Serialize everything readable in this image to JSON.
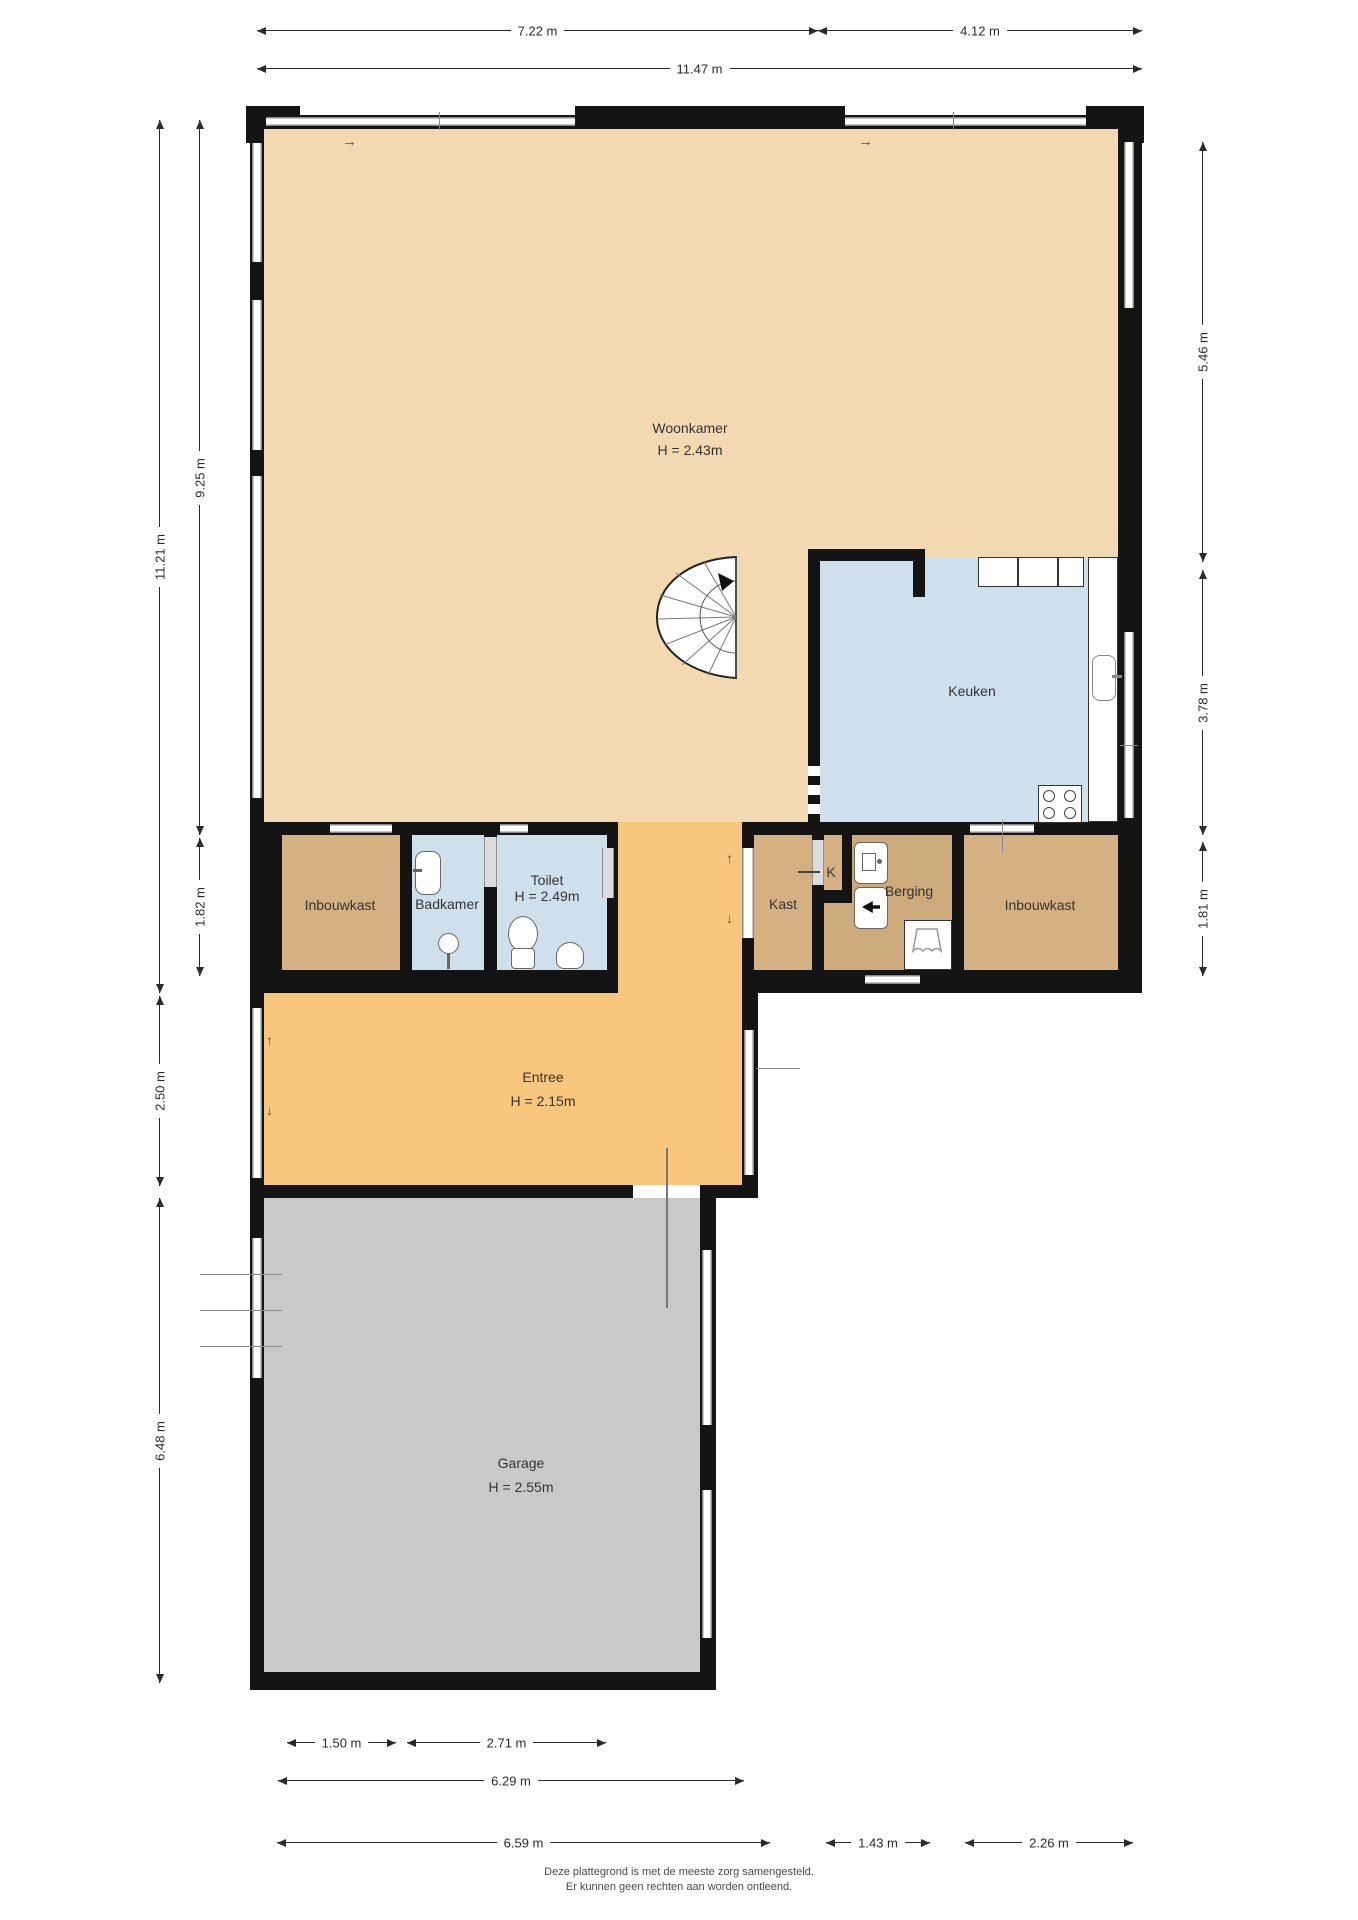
{
  "rooms": {
    "woonkamer": {
      "name": "Woonkamer",
      "h": "H = 2.43m"
    },
    "keuken": {
      "name": "Keuken"
    },
    "inbouwkast_l": {
      "name": "Inbouwkast"
    },
    "badkamer": {
      "name": "Badkamer"
    },
    "toilet": {
      "name": "Toilet",
      "h": "H = 2.49m"
    },
    "kast": {
      "name": "Kast"
    },
    "k": {
      "name": "K"
    },
    "berging": {
      "name": "Berging"
    },
    "inbouwkast_r": {
      "name": "Inbouwkast"
    },
    "entree": {
      "name": "Entree",
      "h": "H = 2.15m"
    },
    "garage": {
      "name": "Garage",
      "h": "H = 2.55m"
    }
  },
  "dims": {
    "top_left": "7.22 m",
    "top_right": "4.12 m",
    "top_full": "11.47 m",
    "left_outer": "11.21 m",
    "left_woonkamer": "9.25 m",
    "left_row": "1.82 m",
    "left_entree": "2.50 m",
    "left_garage": "6.48 m",
    "right_top": "5.46 m",
    "right_mid": "3.78 m",
    "right_row": "1.81 m",
    "bottom_1": "1.50 m",
    "bottom_2": "2.71 m",
    "bottom_3": "6.29 m",
    "bottom_4": "6.59 m",
    "bottom_5": "1.43 m",
    "bottom_6": "2.26 m"
  },
  "disclaimer": {
    "line1": "Deze plattegrond is met de meeste zorg samengesteld.",
    "line2": "Er kunnen geen rechten aan worden ontleend."
  },
  "colors": {
    "floor_living": "#f2d9b2",
    "floor_wet": "#cfe0ed",
    "floor_closet": "#d5b083",
    "floor_storage": "#cdaa7c",
    "floor_entry": "#f8c77d",
    "floor_garage": "#c9c9c9",
    "wall": "#141414",
    "dim": "#2b2b2b"
  }
}
